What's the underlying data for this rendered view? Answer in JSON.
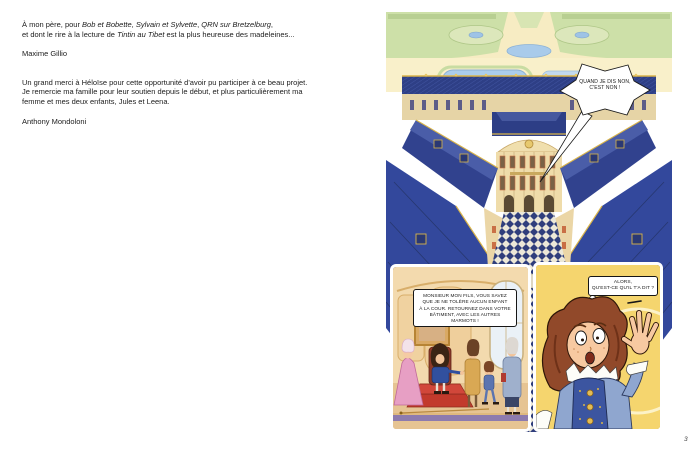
{
  "left_page": {
    "dedication1": {
      "l1_seg1": "À mon père, pour ",
      "l1_title1": "Bob et Bobette",
      "l1_seg2": ", ",
      "l1_title2": "Sylvain et Sylvette",
      "l1_seg3": ", ",
      "l1_title3": "QRN sur Bretzelburg",
      "l1_seg4": ",",
      "l2_seg1": "et dont le rire à la lecture de ",
      "l2_title1": "Tintin au Tibet",
      "l2_seg2": " est la plus heureuse des madeleines...",
      "author": "Maxime Gillio"
    },
    "dedication2": {
      "lines": [
        "Un grand merci à Héloïse pour cette opportunité d'avoir pu participer à ce beau projet.",
        "Je remercie ma famille pour leur soutien depuis le début, et plus particulièrement ma",
        "femme et mes deux enfants, Jules et Leena."
      ],
      "author": "Anthony Mondoloni"
    }
  },
  "right_page": {
    "panel_palace": {
      "description": "aerial-view-of-versailles-palace-and-gardens",
      "bubble_lines": [
        "QUAND JE DIS NON,",
        "C'EST NON !"
      ]
    },
    "panel_throne": {
      "description": "throne-room-king-dismisses-son",
      "bubble_lines": [
        "MONSIEUR MON FILS, VOUS SAVEZ",
        "QUE JE NE TOLÈRE AUCUN ENFANT",
        "À LA COUR. RETOURNEZ DANS VOTRE",
        "BÂTIMENT, AVEC LES AUTRES",
        "MARMOTS !"
      ]
    },
    "panel_louis": {
      "description": "surprised-boy-close-up",
      "bubble_lines": [
        "ALORS,",
        "QU'EST-CE QU'IL T'A DIT ?"
      ]
    },
    "page_number": "3"
  },
  "colors": {
    "roof_blue": "#2e3f86",
    "roof_blue_light": "#4a5da8",
    "stone_cream": "#eddcab",
    "gold_trim": "#d9b44a",
    "garden_green": "#cde0a8",
    "water_blue": "#a9cbea",
    "panel_yellow": "#f5d56e",
    "interior_peach": "#f3daae",
    "carpet_red": "#c23a2c"
  }
}
